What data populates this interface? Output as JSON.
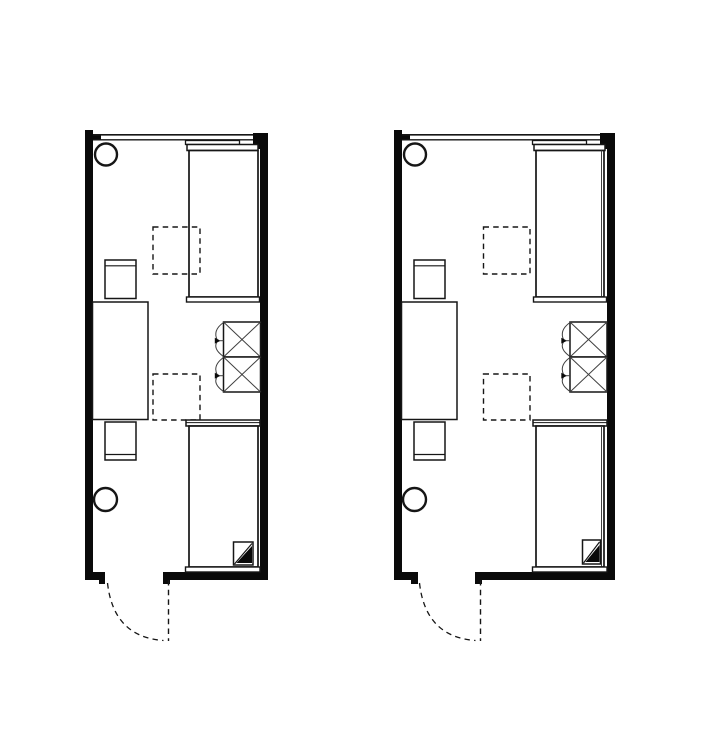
{
  "canvas": {
    "width": 714,
    "height": 737,
    "background": "#ffffff"
  },
  "colors": {
    "wall": "#0a0a0a",
    "line": "#161616",
    "thin": "#3f3f3f",
    "background": "#ffffff"
  },
  "plans": [
    {
      "name": "room-plan-left",
      "shapes": [
        {
          "n": "left-wall",
          "t": "wall",
          "x": 85,
          "y": 130,
          "w": 8,
          "h": 450
        },
        {
          "n": "right-wall",
          "t": "wall",
          "x": 260,
          "y": 133,
          "w": 8,
          "h": 447
        },
        {
          "n": "right-wall-top-pier",
          "t": "wall",
          "x": 253,
          "y": 133,
          "w": 15,
          "h": 16
        },
        {
          "n": "window-left-stub",
          "t": "wall",
          "x": 93,
          "y": 134.5,
          "w": 8,
          "h": 5.5
        },
        {
          "n": "bottom-wall-left",
          "t": "wall",
          "x": 85,
          "y": 572,
          "w": 20,
          "h": 8
        },
        {
          "n": "door-jamb-left",
          "t": "wall",
          "x": 99,
          "y": 579,
          "w": 6,
          "h": 5
        },
        {
          "n": "bottom-wall-right",
          "t": "wall",
          "x": 163,
          "y": 572,
          "w": 105,
          "h": 8
        },
        {
          "n": "door-jamb-right",
          "t": "wall",
          "x": 163,
          "y": 579,
          "w": 7,
          "h": 5
        },
        {
          "n": "window-outer-line",
          "t": "line",
          "x1": 93,
          "y1": 134.8,
          "x2": 253,
          "y2": 134.8,
          "sw": 1.7
        },
        {
          "n": "window-inner-line",
          "t": "line",
          "x1": 93,
          "y1": 139.8,
          "x2": 253,
          "y2": 139.8,
          "sw": 1.3
        },
        {
          "n": "fixture-circle-top",
          "t": "circle",
          "cx": 106,
          "cy": 154.5,
          "r": 11,
          "sw": 2.4
        },
        {
          "n": "fixture-circle-bottom",
          "t": "circle",
          "cx": 105.5,
          "cy": 499.5,
          "r": 11.5,
          "sw": 2.4
        },
        {
          "n": "bed-top-shelf",
          "t": "rect",
          "x": 185.5,
          "y": 140.5,
          "w": 54,
          "h": 4,
          "sw": 1.3
        },
        {
          "n": "bed-top-headboard",
          "t": "rect",
          "x": 187,
          "y": 144.5,
          "w": 71,
          "h": 6,
          "sw": 1.5
        },
        {
          "n": "bed-top-body",
          "t": "rect",
          "x": 189,
          "y": 150.5,
          "w": 69,
          "h": 146.5,
          "sw": 1.7
        },
        {
          "n": "bed-top-footboard",
          "t": "rect",
          "x": 186.5,
          "y": 297,
          "w": 73,
          "h": 5,
          "sw": 1.4
        },
        {
          "n": "chair-top",
          "t": "rect",
          "x": 105,
          "y": 260,
          "w": 31,
          "h": 38.5,
          "sw": 1.5
        },
        {
          "n": "chair-top-backrest-line",
          "t": "line",
          "x1": 105,
          "y1": 265.8,
          "x2": 136,
          "y2": 265.8,
          "sw": 1.2
        },
        {
          "n": "desk",
          "t": "rect",
          "x": 92.5,
          "y": 302,
          "w": 55.5,
          "h": 117.5,
          "sw": 1.5
        },
        {
          "n": "chair-bottom",
          "t": "rect",
          "x": 105,
          "y": 422,
          "w": 31,
          "h": 38,
          "sw": 1.5
        },
        {
          "n": "chair-bottom-backrest-line",
          "t": "line",
          "x1": 105,
          "y1": 454.5,
          "x2": 136,
          "y2": 454.5,
          "sw": 1.2
        },
        {
          "n": "dashed-marker-top",
          "t": "drect",
          "x": 153,
          "y": 227,
          "w": 47,
          "h": 47,
          "sw": 1.4
        },
        {
          "n": "dashed-marker-bottom",
          "t": "drect",
          "x": 153,
          "y": 374,
          "w": 47,
          "h": 46,
          "sw": 1.4
        },
        {
          "n": "wardrobe-box-top",
          "t": "rect",
          "x": 223.5,
          "y": 322,
          "w": 37,
          "h": 35,
          "sw": 1.5
        },
        {
          "n": "wardrobe-top-diag-1",
          "t": "tline",
          "x1": 223.5,
          "y1": 322,
          "x2": 260.5,
          "y2": 357,
          "sw": 1
        },
        {
          "n": "wardrobe-top-diag-2",
          "t": "tline",
          "x1": 260.5,
          "y1": 322,
          "x2": 223.5,
          "y2": 357,
          "sw": 1
        },
        {
          "n": "wardrobe-box-bottom",
          "t": "rect",
          "x": 223.5,
          "y": 357,
          "w": 37,
          "h": 35,
          "sw": 1.5
        },
        {
          "n": "wardrobe-bottom-diag-1",
          "t": "tline",
          "x1": 223.5,
          "y1": 357,
          "x2": 260.5,
          "y2": 392,
          "sw": 1
        },
        {
          "n": "wardrobe-bottom-diag-2",
          "t": "tline",
          "x1": 260.5,
          "y1": 357,
          "x2": 223.5,
          "y2": 392,
          "sw": 1
        },
        {
          "n": "wardrobe-top-door-arcs",
          "t": "path",
          "d": "M 223.5 322.5 Q 212.2 330.5 217.4 340.3 M 223.5 356.5 Q 212.2 348.5 217.4 341.2",
          "sw": 1
        },
        {
          "n": "wardrobe-top-door-arrow",
          "t": "poly",
          "p": "214.8,337.8 214.8,343.6 220.6,340.7"
        },
        {
          "n": "wardrobe-top-door-tick",
          "t": "tline",
          "x1": 219,
          "y1": 340.7,
          "x2": 223.5,
          "y2": 340.7,
          "sw": 1
        },
        {
          "n": "wardrobe-bottom-door-arcs",
          "t": "path",
          "d": "M 223.5 357.5 Q 212.2 365.5 217.4 375.3 M 223.5 391.5 Q 212.2 383.5 217.4 376.2",
          "sw": 1
        },
        {
          "n": "wardrobe-bottom-door-arrow",
          "t": "poly",
          "p": "214.8,372.8 214.8,378.6 220.6,375.7"
        },
        {
          "n": "wardrobe-bottom-door-tick",
          "t": "tline",
          "x1": 219,
          "y1": 375.7,
          "x2": 223.5,
          "y2": 375.7,
          "sw": 1
        },
        {
          "n": "bed-bottom-headboard",
          "t": "rect",
          "x": 186,
          "y": 420,
          "w": 74,
          "h": 6,
          "sw": 1.5
        },
        {
          "n": "bed-bottom-headboard-line",
          "t": "line",
          "x1": 186,
          "y1": 422.6,
          "x2": 260,
          "y2": 422.6,
          "sw": 1
        },
        {
          "n": "bed-bottom-body",
          "t": "rect",
          "x": 189,
          "y": 426,
          "w": 69,
          "h": 141,
          "sw": 1.7
        },
        {
          "n": "bed-bottom-footboard",
          "t": "rect",
          "x": 185.5,
          "y": 567,
          "w": 74.5,
          "h": 5,
          "sw": 1.4
        },
        {
          "n": "corner-marker-box",
          "t": "rect",
          "x": 233.5,
          "y": 542,
          "w": 19.5,
          "h": 23,
          "sw": 1.5
        },
        {
          "n": "corner-marker-diagonal",
          "t": "line",
          "x1": 234.5,
          "y1": 564,
          "x2": 252,
          "y2": 543.5,
          "sw": 1.2
        },
        {
          "n": "corner-marker-fill",
          "t": "poly",
          "p": "236.5,563 252,563 252,546"
        },
        {
          "n": "door-leaf-dashed",
          "t": "dline",
          "x1": 168.5,
          "y1": 580,
          "x2": 168.5,
          "y2": 641,
          "sw": 1.4
        },
        {
          "n": "door-swing-arc",
          "t": "dpath",
          "d": "M 107.5 583 Q 113.5 637 163.5 640.5",
          "sw": 1.3
        }
      ]
    },
    {
      "name": "room-plan-right",
      "shapes": [
        {
          "n": "left-wall",
          "t": "wall",
          "x": 394,
          "y": 130,
          "w": 8,
          "h": 450
        },
        {
          "n": "right-wall",
          "t": "wall",
          "x": 607,
          "y": 133,
          "w": 8,
          "h": 447
        },
        {
          "n": "right-wall-top-pier",
          "t": "wall",
          "x": 600,
          "y": 133,
          "w": 15,
          "h": 16
        },
        {
          "n": "window-left-stub",
          "t": "wall",
          "x": 402,
          "y": 134.5,
          "w": 8,
          "h": 5.5
        },
        {
          "n": "bottom-wall-left",
          "t": "wall",
          "x": 394,
          "y": 572,
          "w": 24,
          "h": 8
        },
        {
          "n": "door-jamb-left",
          "t": "wall",
          "x": 411,
          "y": 579,
          "w": 7,
          "h": 5
        },
        {
          "n": "bottom-wall-right",
          "t": "wall",
          "x": 475,
          "y": 572,
          "w": 140,
          "h": 8
        },
        {
          "n": "door-jamb-right",
          "t": "wall",
          "x": 475,
          "y": 579,
          "w": 7,
          "h": 5
        },
        {
          "n": "window-outer-line",
          "t": "line",
          "x1": 402,
          "y1": 134.8,
          "x2": 600,
          "y2": 134.8,
          "sw": 1.7
        },
        {
          "n": "window-inner-line",
          "t": "line",
          "x1": 402,
          "y1": 139.8,
          "x2": 600,
          "y2": 139.8,
          "sw": 1.3
        },
        {
          "n": "fixture-circle-top",
          "t": "circle",
          "cx": 415,
          "cy": 154.5,
          "r": 11,
          "sw": 2.4
        },
        {
          "n": "fixture-circle-bottom",
          "t": "circle",
          "cx": 414.5,
          "cy": 499.5,
          "r": 11.5,
          "sw": 2.4
        },
        {
          "n": "bed-top-shelf",
          "t": "rect",
          "x": 532.5,
          "y": 140.5,
          "w": 54,
          "h": 4,
          "sw": 1.3
        },
        {
          "n": "bed-top-headboard",
          "t": "rect",
          "x": 534,
          "y": 144.5,
          "w": 71,
          "h": 6,
          "sw": 1.5
        },
        {
          "n": "bed-top-body",
          "t": "rect",
          "x": 536,
          "y": 150.5,
          "w": 68,
          "h": 146.5,
          "sw": 1.7
        },
        {
          "n": "bed-top-siderail",
          "t": "tline",
          "x1": 601.5,
          "y1": 150.5,
          "x2": 601.5,
          "y2": 297,
          "sw": 1
        },
        {
          "n": "bed-top-footboard",
          "t": "rect",
          "x": 533.5,
          "y": 297,
          "w": 73,
          "h": 5,
          "sw": 1.4
        },
        {
          "n": "chair-top",
          "t": "rect",
          "x": 414,
          "y": 260,
          "w": 31,
          "h": 38.5,
          "sw": 1.5
        },
        {
          "n": "chair-top-backrest-line",
          "t": "line",
          "x1": 414,
          "y1": 265.8,
          "x2": 445,
          "y2": 265.8,
          "sw": 1.2
        },
        {
          "n": "desk",
          "t": "rect",
          "x": 401.5,
          "y": 302,
          "w": 55.5,
          "h": 117.5,
          "sw": 1.5
        },
        {
          "n": "chair-bottom",
          "t": "rect",
          "x": 414,
          "y": 422,
          "w": 31,
          "h": 38,
          "sw": 1.5
        },
        {
          "n": "chair-bottom-backrest-line",
          "t": "line",
          "x1": 414,
          "y1": 454.5,
          "x2": 445,
          "y2": 454.5,
          "sw": 1.2
        },
        {
          "n": "dashed-marker-top",
          "t": "drect",
          "x": 483.5,
          "y": 227,
          "w": 46.5,
          "h": 47,
          "sw": 1.4
        },
        {
          "n": "dashed-marker-bottom",
          "t": "drect",
          "x": 483.5,
          "y": 374,
          "w": 46.5,
          "h": 46,
          "sw": 1.4
        },
        {
          "n": "wardrobe-box-top",
          "t": "rect",
          "x": 570,
          "y": 322,
          "w": 37,
          "h": 35,
          "sw": 1.5
        },
        {
          "n": "wardrobe-top-diag-1",
          "t": "tline",
          "x1": 570,
          "y1": 322,
          "x2": 607,
          "y2": 357,
          "sw": 1
        },
        {
          "n": "wardrobe-top-diag-2",
          "t": "tline",
          "x1": 607,
          "y1": 322,
          "x2": 570,
          "y2": 357,
          "sw": 1
        },
        {
          "n": "wardrobe-box-bottom",
          "t": "rect",
          "x": 570,
          "y": 357,
          "w": 37,
          "h": 35,
          "sw": 1.5
        },
        {
          "n": "wardrobe-bottom-diag-1",
          "t": "tline",
          "x1": 570,
          "y1": 357,
          "x2": 607,
          "y2": 392,
          "sw": 1
        },
        {
          "n": "wardrobe-bottom-diag-2",
          "t": "tline",
          "x1": 607,
          "y1": 357,
          "x2": 570,
          "y2": 392,
          "sw": 1
        },
        {
          "n": "wardrobe-top-door-arcs",
          "t": "path",
          "d": "M 570 322.5 Q 558.7 330.5 563.9 340.3 M 570 356.5 Q 558.7 348.5 563.9 341.2",
          "sw": 1
        },
        {
          "n": "wardrobe-top-door-arrow",
          "t": "poly",
          "p": "561.3,337.8 561.3,343.6 567.1,340.7"
        },
        {
          "n": "wardrobe-top-door-tick",
          "t": "tline",
          "x1": 565.5,
          "y1": 340.7,
          "x2": 570,
          "y2": 340.7,
          "sw": 1
        },
        {
          "n": "wardrobe-bottom-door-arcs",
          "t": "path",
          "d": "M 570 357.5 Q 558.7 365.5 563.9 375.3 M 570 391.5 Q 558.7 383.5 563.9 376.2",
          "sw": 1
        },
        {
          "n": "wardrobe-bottom-door-arrow",
          "t": "poly",
          "p": "561.3,372.8 561.3,378.6 567.1,375.7"
        },
        {
          "n": "wardrobe-bottom-door-tick",
          "t": "tline",
          "x1": 565.5,
          "y1": 375.7,
          "x2": 570,
          "y2": 375.7,
          "sw": 1
        },
        {
          "n": "bed-bottom-headboard",
          "t": "rect",
          "x": 533,
          "y": 420,
          "w": 74,
          "h": 6,
          "sw": 1.5
        },
        {
          "n": "bed-bottom-headboard-line",
          "t": "line",
          "x1": 533,
          "y1": 422.6,
          "x2": 607,
          "y2": 422.6,
          "sw": 1
        },
        {
          "n": "bed-bottom-body",
          "t": "rect",
          "x": 536,
          "y": 426,
          "w": 68,
          "h": 141,
          "sw": 1.7
        },
        {
          "n": "bed-bottom-siderail",
          "t": "tline",
          "x1": 601.5,
          "y1": 426,
          "x2": 601.5,
          "y2": 567,
          "sw": 1
        },
        {
          "n": "bed-bottom-footboard",
          "t": "rect",
          "x": 532.5,
          "y": 567,
          "w": 74.5,
          "h": 5,
          "sw": 1.4
        },
        {
          "n": "corner-marker-box",
          "t": "rect",
          "x": 582.5,
          "y": 540,
          "w": 18,
          "h": 24,
          "sw": 1.5
        },
        {
          "n": "corner-marker-diagonal",
          "t": "line",
          "x1": 583.5,
          "y1": 563,
          "x2": 599.5,
          "y2": 542,
          "sw": 1.2
        },
        {
          "n": "corner-marker-fill",
          "t": "poly",
          "p": "585.5,562 599.5,562 599.5,545"
        },
        {
          "n": "door-leaf-dashed",
          "t": "dline",
          "x1": 480.5,
          "y1": 580,
          "x2": 480.5,
          "y2": 641,
          "sw": 1.4
        },
        {
          "n": "door-swing-arc",
          "t": "dpath",
          "d": "M 419.5 583 Q 425.5 637 475.5 640.5",
          "sw": 1.3
        }
      ]
    }
  ]
}
